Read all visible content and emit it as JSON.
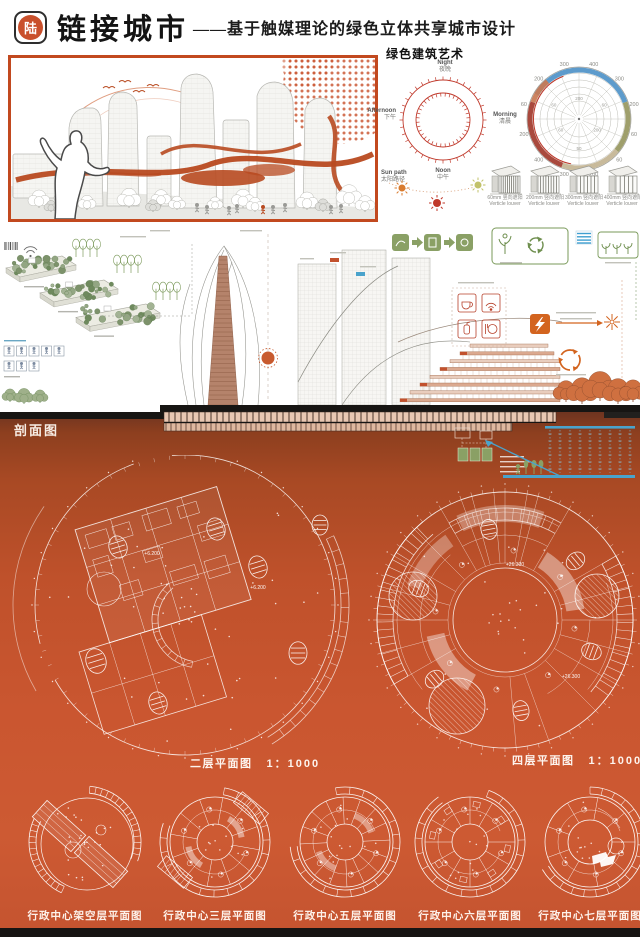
{
  "colors": {
    "accent": "#c2491f",
    "orange_bg": "#c4532c",
    "badge": "#c9502c",
    "green": "#8aa065",
    "blue": "#4aa3cc",
    "red": "#b6402a"
  },
  "header": {
    "badge": "陆",
    "title": "链接城市",
    "subtitle": "——基于触媒理论的绿色立体共享城市设计"
  },
  "green_art": {
    "title": "绿色建筑艺术",
    "clock_labels": [
      {
        "en": "Night",
        "cn": "夜晚"
      },
      {
        "en": "Morning",
        "cn": "清晨"
      },
      {
        "en": "Noon",
        "cn": "中午"
      },
      {
        "en": "Afternoon",
        "cn": "下午"
      }
    ],
    "sun_path": {
      "en": "Sun path",
      "cn": "太阳路径"
    },
    "polar_ring_values": [
      "60",
      "200",
      "300",
      "400",
      "300",
      "200",
      "60",
      "60",
      "200",
      "300",
      "400",
      "200"
    ],
    "polar_inner_values": [
      "60",
      "200",
      "60",
      "200",
      "50",
      "60"
    ],
    "louvers": [
      {
        "size": "60mm",
        "cn": "竖向遮阳",
        "en": "Verticle louver"
      },
      {
        "size": "200mm",
        "cn": "竖向遮阳",
        "en": "Verticle louver"
      },
      {
        "size": "300mm",
        "cn": "竖向遮阳",
        "en": "Verticle louver"
      },
      {
        "size": "400mm",
        "cn": "竖向遮阳",
        "en": "Verticle louver"
      }
    ]
  },
  "section": {
    "label": "剖面图"
  },
  "plans": {
    "left": {
      "name": "二层平面图",
      "scale": "1：1000",
      "elev": "+6.200"
    },
    "right": {
      "name": "四层平面图",
      "scale": "1：1000",
      "elev": "+26.300"
    }
  },
  "floor_plans": [
    {
      "label": "行政中心架空层平面图"
    },
    {
      "label": "行政中心三层平面图"
    },
    {
      "label": "行政中心五层平面图"
    },
    {
      "label": "行政中心六层平面图"
    },
    {
      "label": "行政中心七层平面图"
    }
  ]
}
